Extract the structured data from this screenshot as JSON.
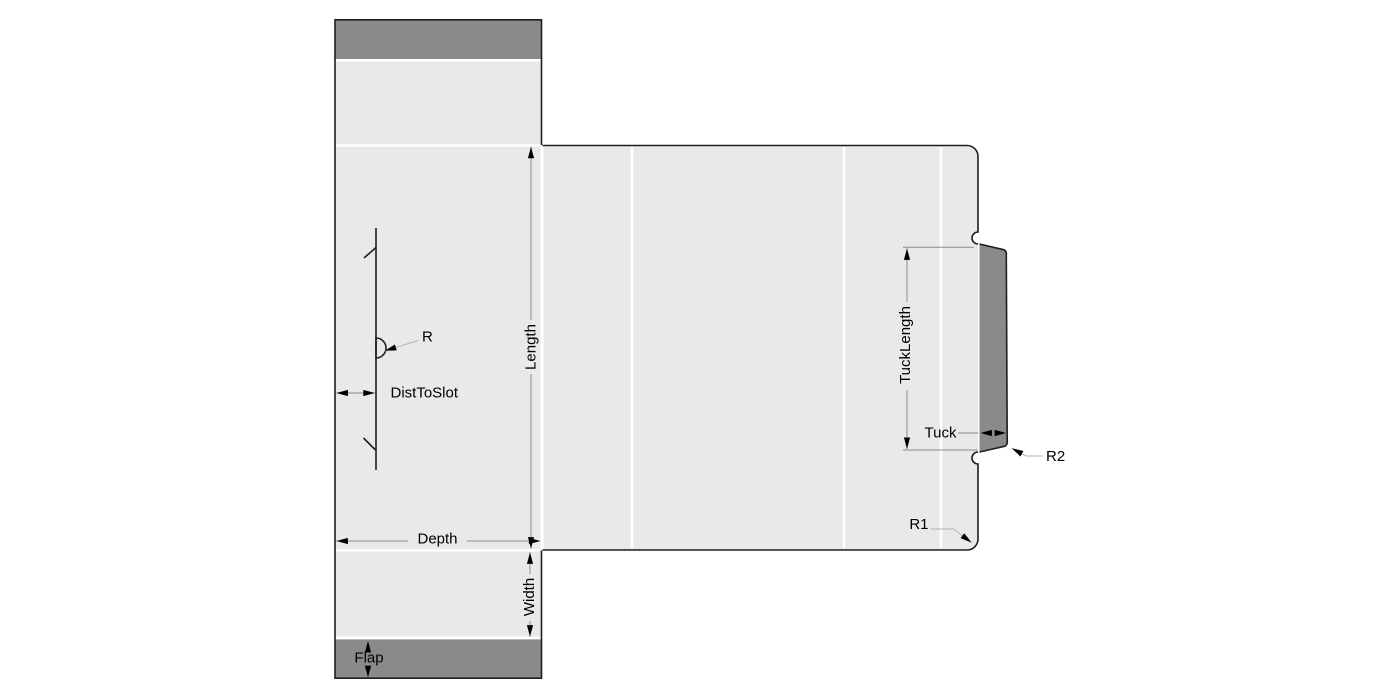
{
  "diagram": {
    "type": "carton-dieline-drawing",
    "labels": {
      "length": "Length",
      "width": "Width",
      "depth": "Depth",
      "flap": "Flap",
      "dist_to_slot": "DistToSlot",
      "radius": "R",
      "radius1": "R1",
      "radius2": "R2",
      "tuck": "Tuck",
      "tuck_length": "TuckLength"
    },
    "colors": {
      "background": "#ffffff",
      "panel_fill": "#e9e9e9",
      "flap_fill": "#8a8a8a",
      "outline": "#1f1f1f",
      "fold_line": "#ffffff",
      "dimension_line": "#8c8c8c",
      "leader_line": "#b3b3b3",
      "arrow": "#000000",
      "text": "#000000"
    }
  }
}
